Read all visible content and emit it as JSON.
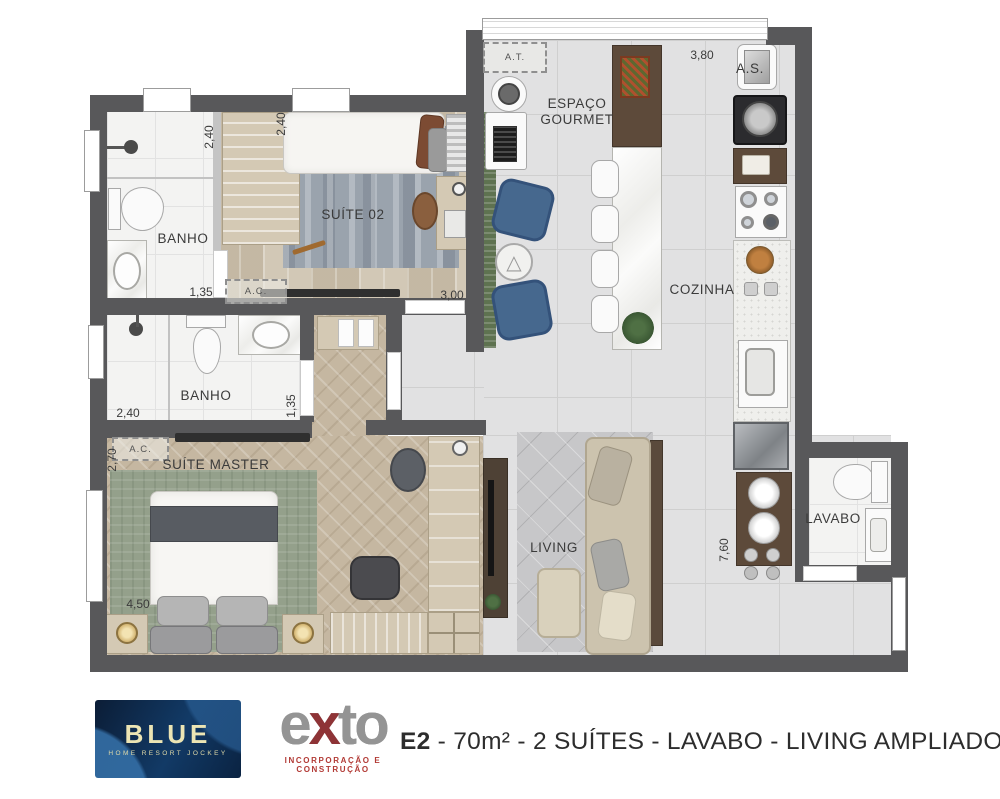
{
  "colors": {
    "wall": "#58585a",
    "logo_navy": "#0b1d36",
    "logo_cream": "#ece5b4",
    "exto_gray": "#8f8f8f",
    "exto_red": "#8e3336"
  },
  "plan": {
    "rooms": {
      "banho1": "BANHO",
      "suite02": "SUÍTE 02",
      "gourmet": "ESPAÇO GOURMET",
      "cozinha": "COZINHA",
      "banho2": "BANHO",
      "suite_master": "SUÍTE MASTER",
      "living": "LIVING",
      "lavabo": "LAVABO"
    },
    "annotations": {
      "at": "A.T.",
      "as": "A.S.",
      "ac": "A.C."
    },
    "dimensions": {
      "banho1_v": "2,40",
      "banho1_h": "1,35",
      "suite02_v": "2,40",
      "suite02_h": "3,00",
      "gourmet_h": "3,80",
      "banho2_h": "2,40",
      "banho2_v": "1,35",
      "master_v": "2,70",
      "master_h": "4,50",
      "cozinha_v": "7,60"
    }
  },
  "footer": {
    "blue_logo": {
      "title": "BLUE",
      "subtitle": "HOME RESORT JOCKEY"
    },
    "exto_logo": {
      "name_e": "e",
      "name_x": "x",
      "name_to": "to",
      "tagline": "INCORPORAÇÃO E CONSTRUÇÃO"
    },
    "caption": {
      "unit": "E2",
      "details": " - 70m² - 2 SUÍTES - LAVABO - LIVING AMPLIADO"
    }
  }
}
